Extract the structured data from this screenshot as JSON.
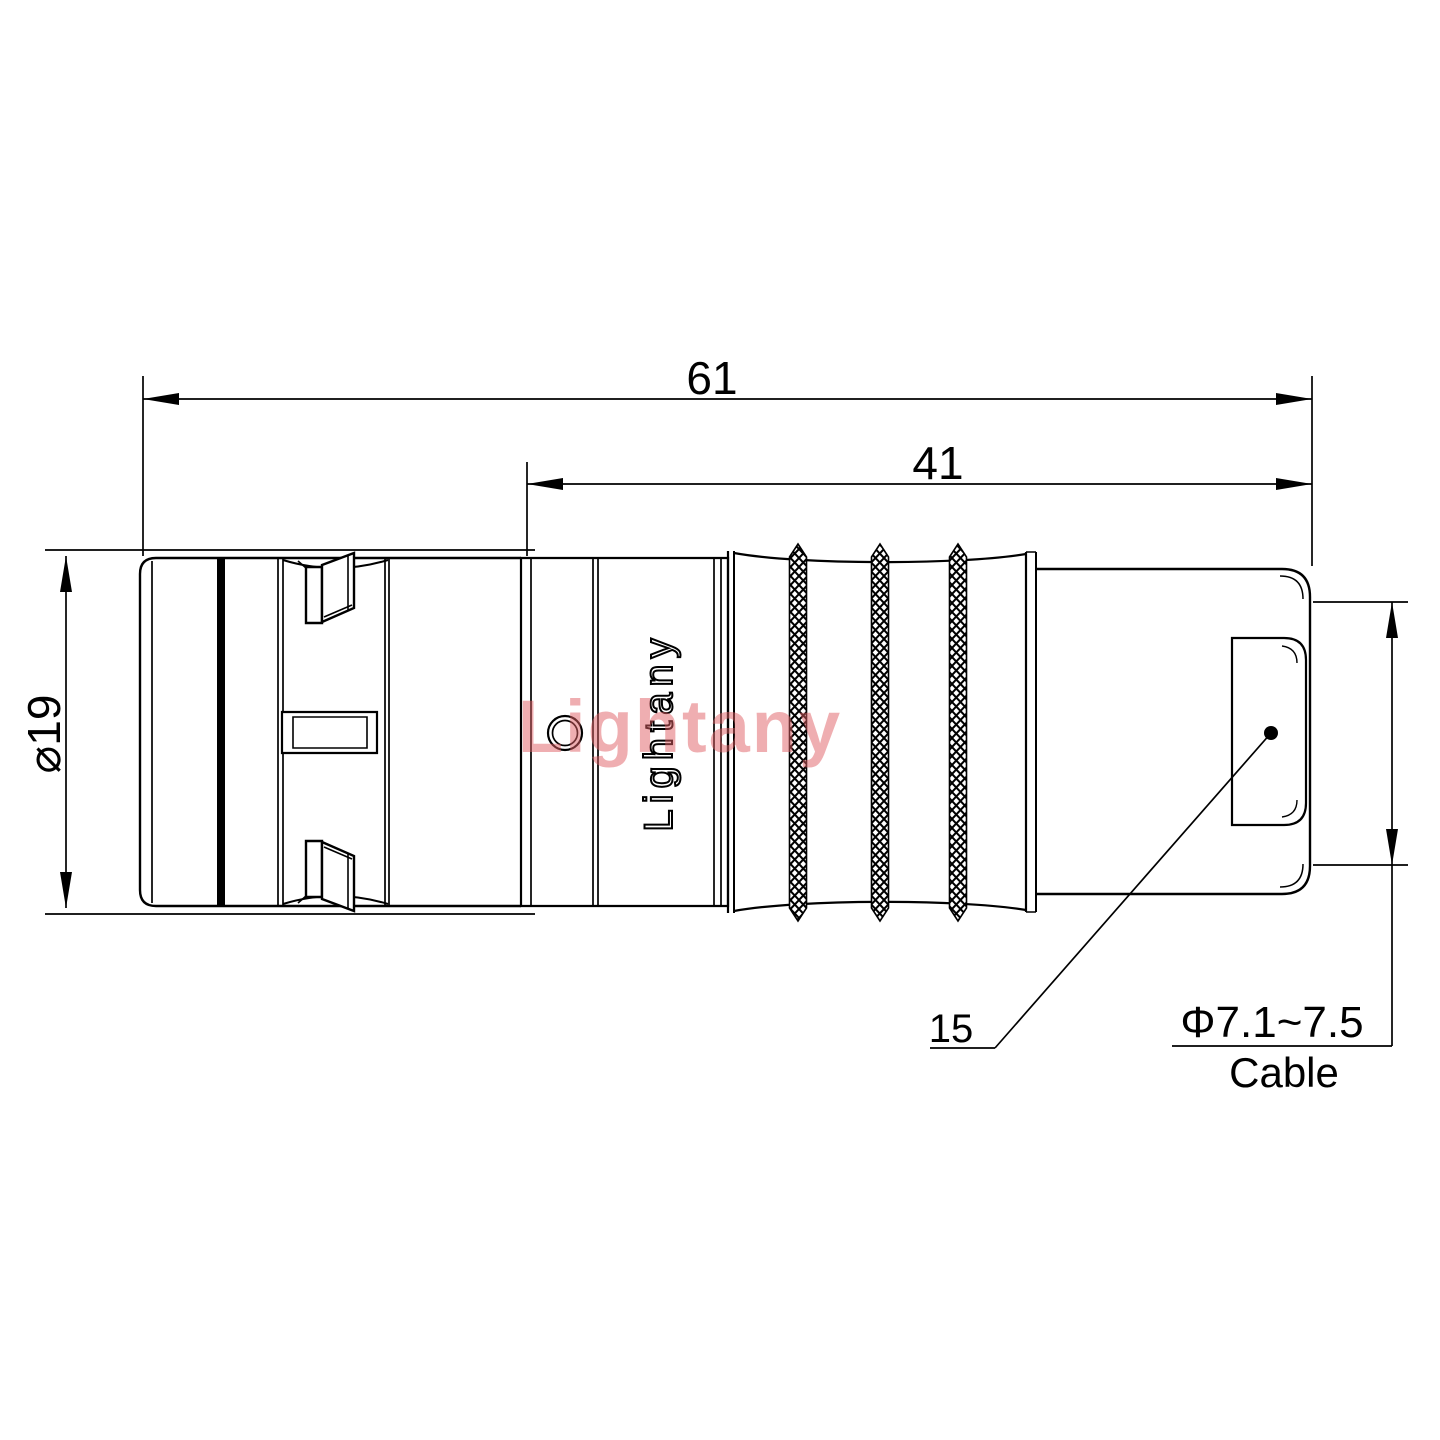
{
  "drawing": {
    "title": "connector-dimension-drawing",
    "dimensions": {
      "total_length": "61",
      "rear_length": "41",
      "body_diameter": "⌀19",
      "boot_length": "15"
    },
    "cable": {
      "spec": "Φ7.1~7.5",
      "label": "Cable"
    },
    "brand": {
      "engraving": "Lightany",
      "watermark": "Lightany"
    },
    "colors": {
      "line": "#000000",
      "background": "#ffffff",
      "watermark": "#e06065"
    }
  }
}
